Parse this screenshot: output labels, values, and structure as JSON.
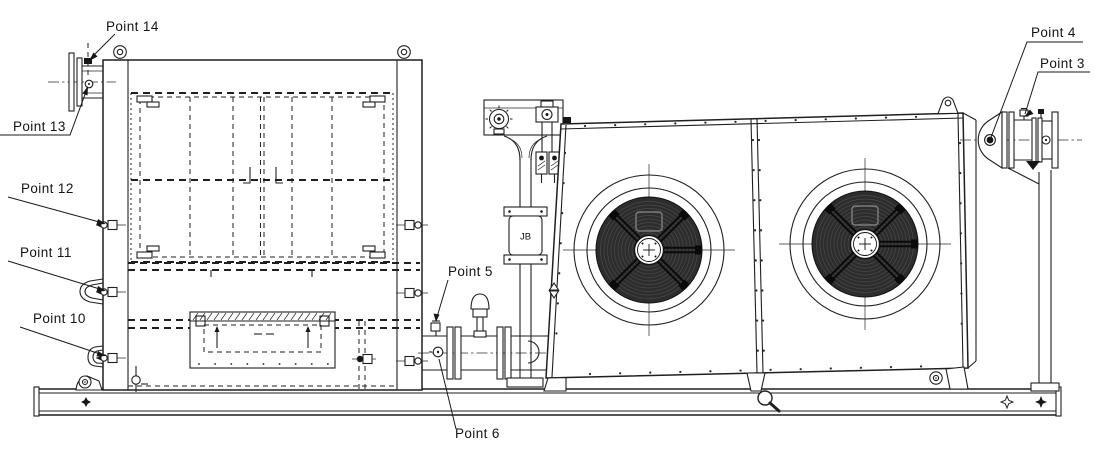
{
  "drawing": {
    "type": "engineering-elevation-diagram",
    "description": "Side elevation of a skid mounted package: filter/tank enclosure with access doors, instrument stand with junction box, flow meter pipe spool, twin-fan air cooler and flanged nozzles, with numbered inspection point callouts",
    "labels": {
      "point3": "Point 3",
      "point4": "Point 4",
      "point5": "Point 5",
      "point6": "Point 6",
      "point10": "Point 10",
      "point11": "Point 11",
      "point12": "Point 12",
      "point13": "Point 13",
      "point14": "Point 14"
    },
    "junction_box": "JB",
    "symbols": [
      "magnifier-icon",
      "lifting-eyebolt-icon",
      "lifting-lug-icon",
      "level-indicator-icon",
      "anchor-star-icon",
      "skid-diamond-icon"
    ],
    "colors": {
      "background": "#ffffff",
      "line": "#1f1f1f",
      "fan_mesh": "#2d2d2d",
      "mesh_ring": "#4a4a4a"
    }
  }
}
